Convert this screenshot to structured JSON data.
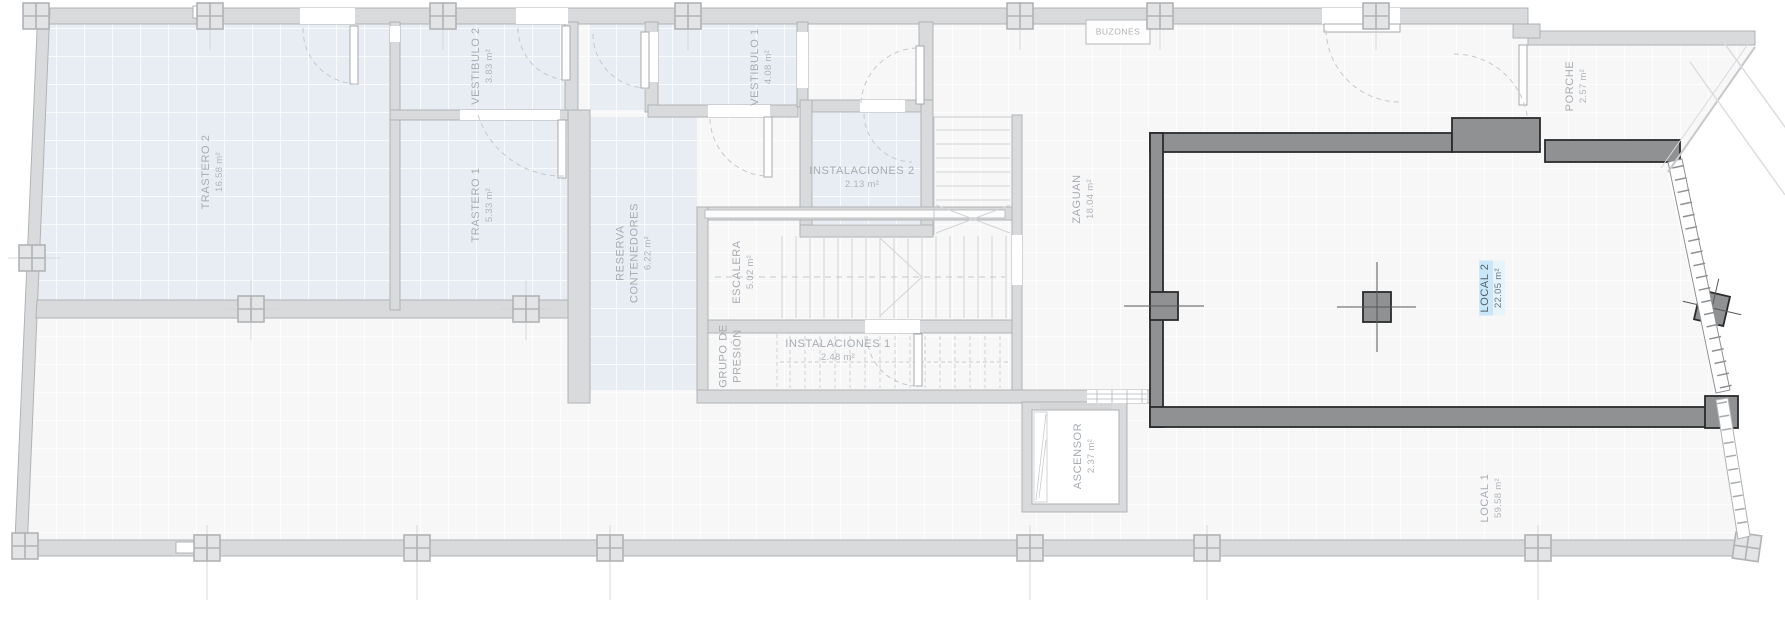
{
  "rooms": [
    {
      "id": "trastero-2",
      "name": "TRASTERO 2",
      "area": "16.58 m²"
    },
    {
      "id": "vestibulo-2",
      "name": "VESTIBULO 2",
      "area": "3.83 m²"
    },
    {
      "id": "trastero-1",
      "name": "TRASTERO 1",
      "area": "5.33 m²"
    },
    {
      "id": "vestibulo-1",
      "name": "VESTIBULO 1",
      "area": "4.08 m²"
    },
    {
      "id": "instalaciones-2",
      "name": "INSTALACIONES 2",
      "area": "2.13 m²"
    },
    {
      "id": "reserva-contenedores",
      "name": "RESERVA CONTENEDORES",
      "area": "6.22 m²"
    },
    {
      "id": "escalera",
      "name": "ESCALERA",
      "area": "5.02 m²"
    },
    {
      "id": "grupo-de-presion",
      "name": "GRUPO DE PRESIÓN",
      "area": ""
    },
    {
      "id": "instalaciones-1",
      "name": "INSTALACIONES 1",
      "area": "2.48 m²"
    },
    {
      "id": "zaguan",
      "name": "ZAGUAN",
      "area": "18.04 m²"
    },
    {
      "id": "ascensor",
      "name": "ASCENSOR",
      "area": "2.37 m²"
    },
    {
      "id": "local-2",
      "name": "LOCAL 2",
      "area": "22.05 m²",
      "highlighted": true
    },
    {
      "id": "local-1",
      "name": "LOCAL 1",
      "area": "59.58 m²"
    },
    {
      "id": "porche",
      "name": "PORCHE",
      "area": "2.57 m²"
    }
  ],
  "fixtures": {
    "mailboxes_label": "BUZONES"
  },
  "colors": {
    "wall_light": "#d9dadb",
    "wall_dark": "#8f9193",
    "room_communal": "#e8edf4",
    "highlight": "#c9e7f8",
    "text": "#a7acb1"
  }
}
